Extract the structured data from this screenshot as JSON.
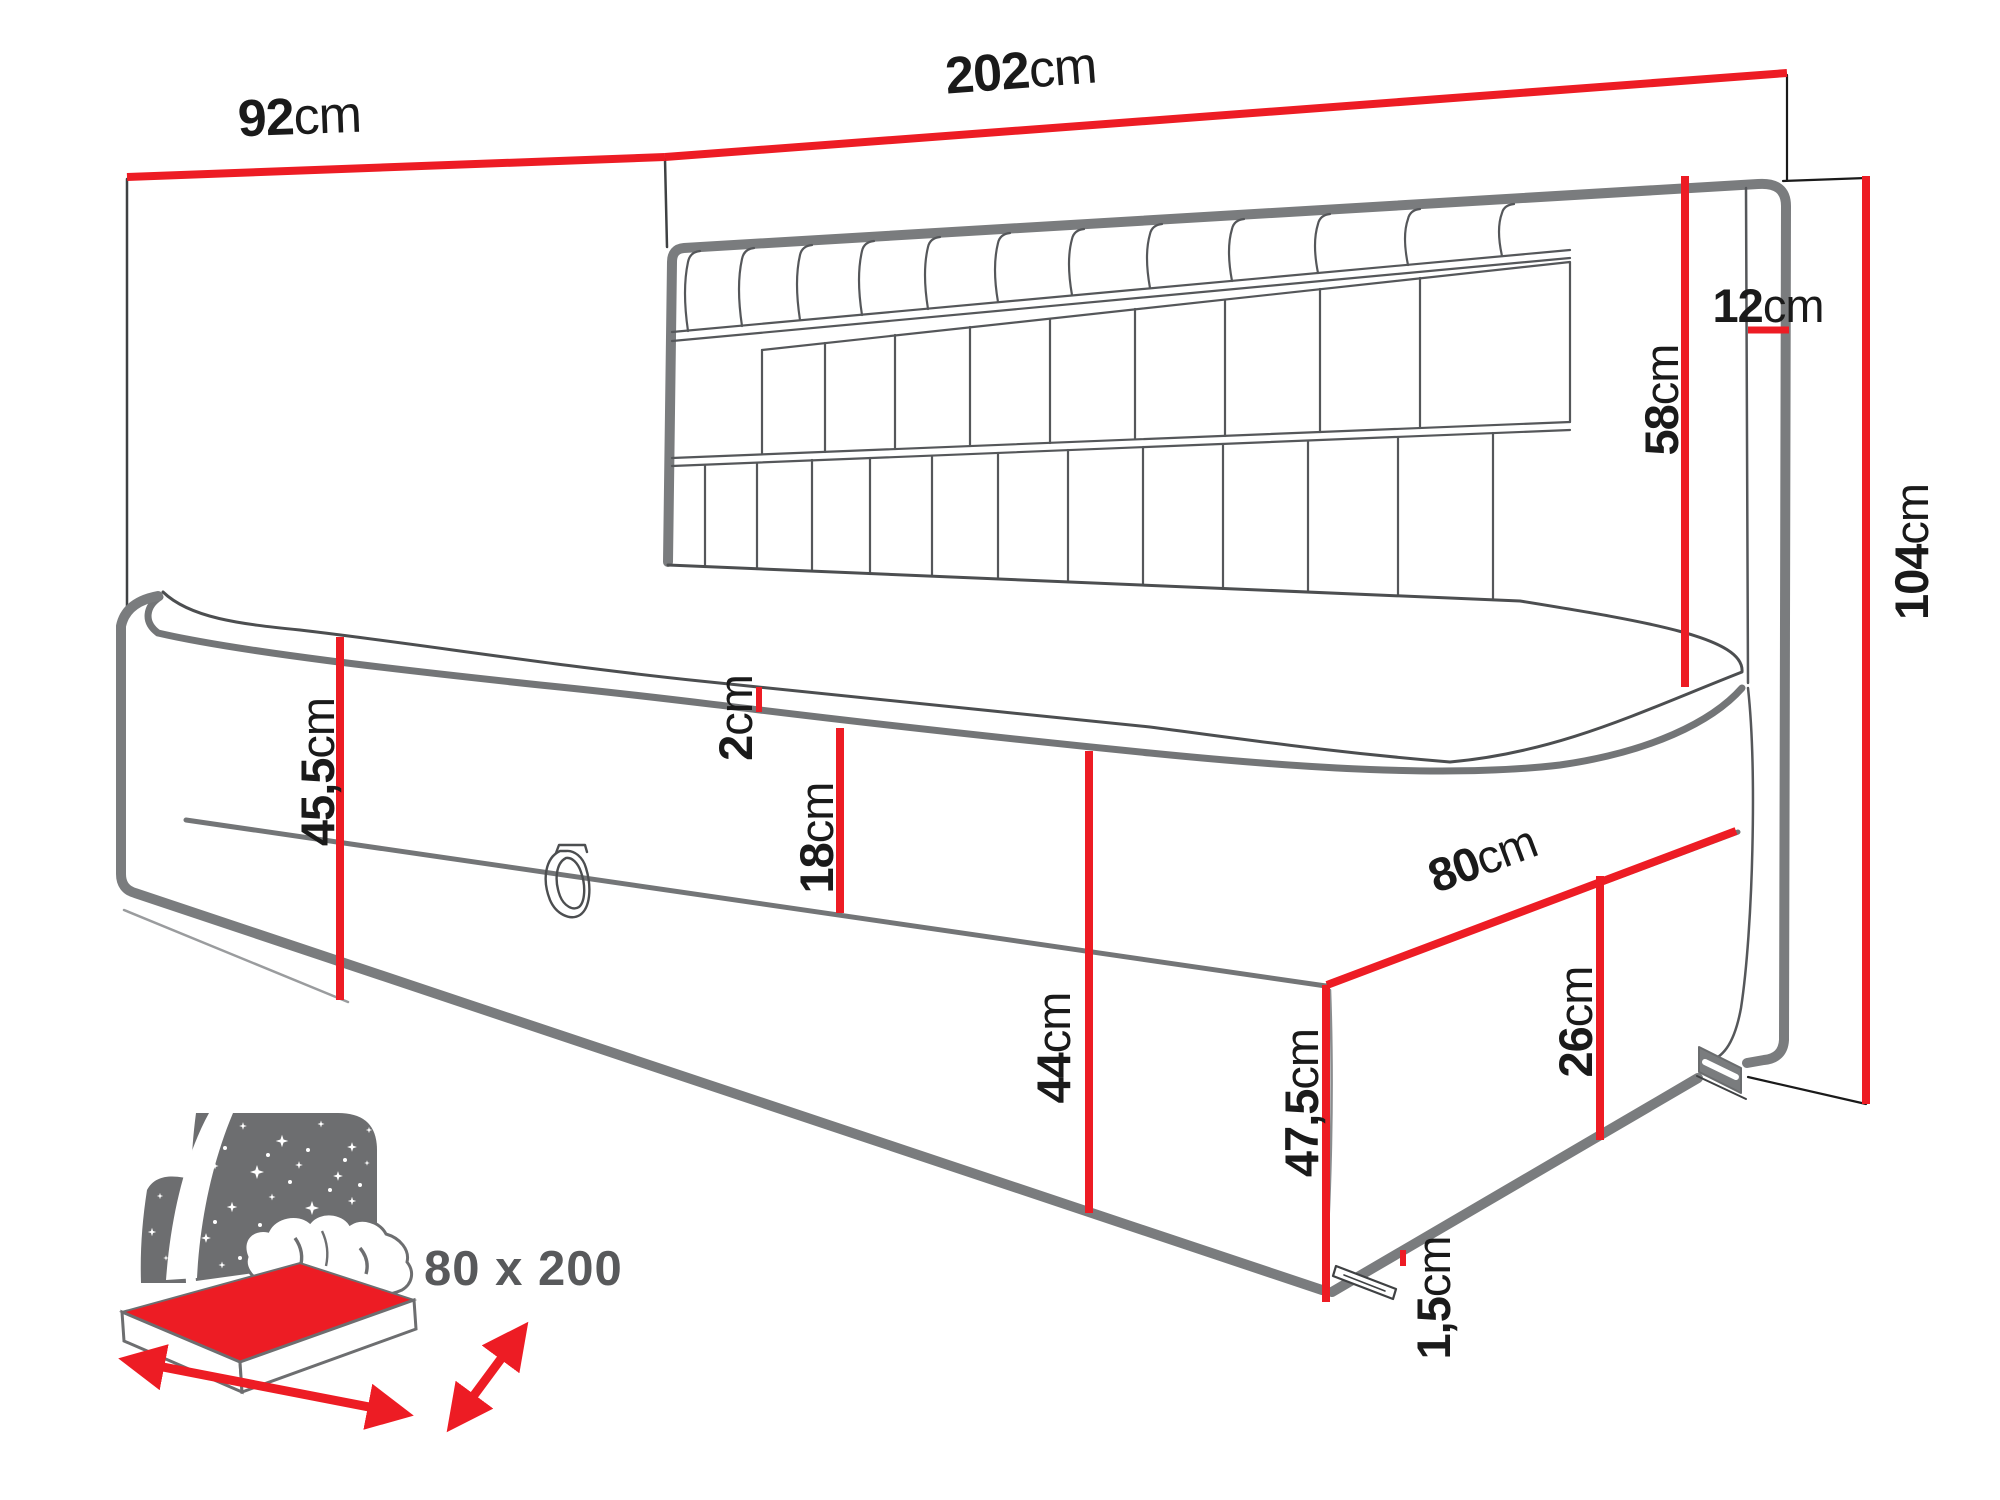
{
  "diagram_title": "corner daybed dimension drawing",
  "colors": {
    "dimension_red": "#ed1c24",
    "outline_gray": "#7a7c7e",
    "line_dark": "#4c4e50",
    "icon_gray": "#6d6e70",
    "badge_text_gray": "#58595b",
    "label_black": "#1a1a1a"
  },
  "dimensions": {
    "side_panel_width": {
      "value": "92",
      "unit": "cm"
    },
    "headboard_length": {
      "value": "202",
      "unit": "cm"
    },
    "headboard_thickness": {
      "value": "12",
      "unit": "cm"
    },
    "headboard_above_mattress": {
      "value": "58",
      "unit": "cm"
    },
    "total_height": {
      "value": "104",
      "unit": "cm"
    },
    "left_base_height": {
      "value": "45,5",
      "unit": "cm"
    },
    "topper_height": {
      "value": "2",
      "unit": "cm"
    },
    "mattress_height": {
      "value": "18",
      "unit": "cm"
    },
    "storage_box_height": {
      "value": "44",
      "unit": "cm"
    },
    "corner_height": {
      "value": "47,5",
      "unit": "cm"
    },
    "side_width": {
      "value": "80",
      "unit": "cm"
    },
    "side_lower_height": {
      "value": "26",
      "unit": "cm"
    },
    "glide_height": {
      "value": "1,5",
      "unit": "cm"
    }
  },
  "badge": {
    "size_label": "80 x 200"
  }
}
